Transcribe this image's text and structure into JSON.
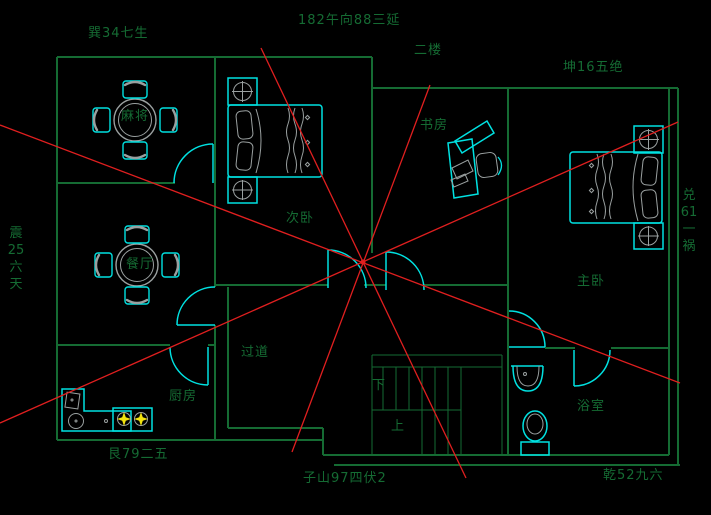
{
  "drawing_title": "二楼",
  "labels": {
    "compass": {
      "top_left": "巽34七生",
      "top_center": "182午向88三延",
      "floor": "二楼",
      "top_right": "坤16五绝",
      "left_vertical": [
        "震",
        "25",
        "六",
        "天"
      ],
      "right_vertical": [
        "兑",
        "61",
        "一",
        "祸"
      ],
      "bottom_left": "艮79二五",
      "bottom_center": "子山97四伏2",
      "bottom_right": "乾52九六"
    },
    "rooms": {
      "mahjong": "麻将",
      "dining": "餐厅",
      "kitchen": "厨房",
      "second_bedroom": "次卧",
      "study": "书房",
      "master_bedroom": "主卧",
      "hallway": "过道",
      "bathroom": "浴室",
      "stairs_down": "下",
      "stairs_up": "上"
    }
  },
  "colors": {
    "background": "#000000",
    "walls_and_text": "#156b33",
    "furniture": "#00e1e1",
    "furniture_detail": "#9aa0a0",
    "feng_shui_rays": "#e01f1f",
    "stove_burners": "#f2e30e"
  },
  "center_point": {
    "x": 363,
    "y": 262
  }
}
